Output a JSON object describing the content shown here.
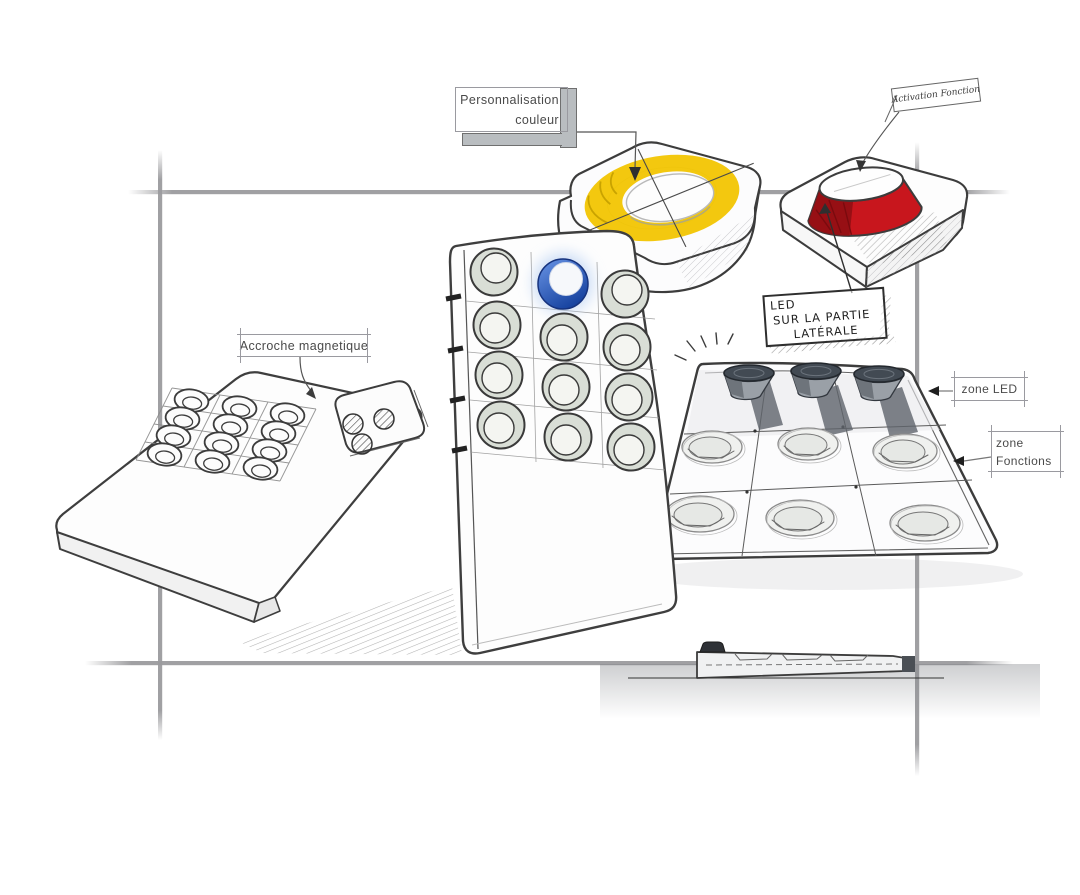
{
  "labels": {
    "personnalisation_line1": "Personnalisation",
    "personnalisation_line2": "couleur",
    "accroche": "Accroche magnetique",
    "zone_led": "zone LED",
    "zone_fonctions_line1": "zone",
    "zone_fonctions_line2": "Fonctions",
    "led_note_line1": "LED",
    "led_note_line2": "SUR LA PARTIE",
    "led_note_line3": "LATÉRALE",
    "activation_note": "Activation Fonction"
  },
  "icons": {
    "zone_led_arrow": "◄",
    "zone_fonctions_arrow": "◄",
    "color_leader_arrow": "▼",
    "accroche_leader_arrow": "▼"
  },
  "colors": {
    "accent_yellow": "#F2C500",
    "accent_red": "#C8161D",
    "accent_blue": "#2B5FC7",
    "blue_glow": "#9CBCF0",
    "construction_gray": "#9B9B9E",
    "sketch_ink": "#3C3C3C",
    "label_text": "#4A4A4A",
    "bar_gray": "#B9BDC0"
  },
  "figures": [
    {
      "name": "flat-magnetic-pad"
    },
    {
      "name": "detachable-function-module"
    },
    {
      "name": "upright-keypad-3x4"
    },
    {
      "name": "blue-active-button"
    },
    {
      "name": "yellow-color-ring-module"
    },
    {
      "name": "red-led-button-module"
    },
    {
      "name": "function-tray-3x3"
    },
    {
      "name": "device-side-profile"
    }
  ]
}
